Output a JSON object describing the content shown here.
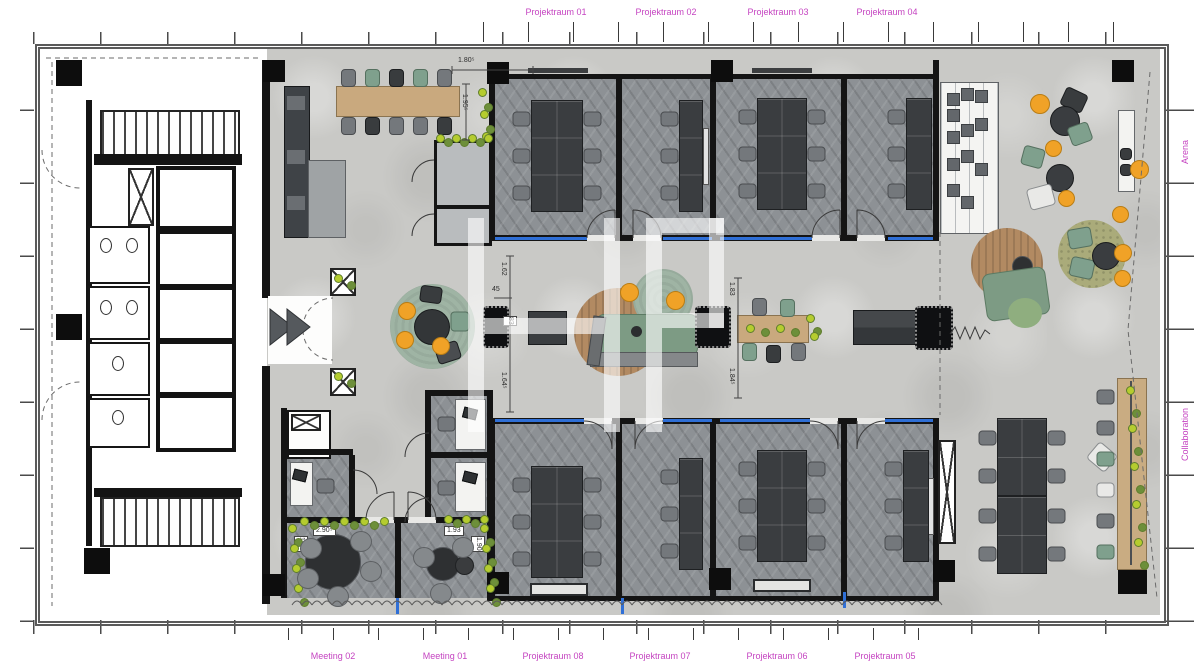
{
  "labels": {
    "top": [
      "Projektraum 01",
      "Projektraum 02",
      "Projektraum 03",
      "Projektraum 04"
    ],
    "bottom": [
      "Meeting 02",
      "Meeting 01",
      "Projektraum 08",
      "Projektraum 07",
      "Projektraum 06",
      "Projektraum 05"
    ],
    "right": [
      "Arena",
      "Collaboration"
    ]
  },
  "watermark": "HP",
  "dims": {
    "top_table_w": "1.80⁵",
    "top_table_h": "1.95⁵",
    "mid_left_a": "1.62",
    "mid_left_b": "45",
    "mid_left_c": "83",
    "mid_left_d": "1.64⁵",
    "mid_right_a": "1.83",
    "mid_right_b": "1.84⁵",
    "meeting02_w": "2.90⁵",
    "meeting02_h": "1.90",
    "meeting01_w": "1.93",
    "meeting01_h": "1.90"
  },
  "colors": {
    "label_magenta": "#c544c1",
    "glass_blue": "#2f6fd6",
    "floor_concrete": "#c9c9c6",
    "carpet_gray": "#8d9195",
    "wall_black": "#141414",
    "wood_tan": "#c9a97e",
    "table_dark": "#3a3d40",
    "chair_gray": "#74787c",
    "chair_green": "#7fa08d",
    "pouf_orange": "#f0a227",
    "rug_green": "#9fb4a4",
    "rug_olive": "#aaab7a",
    "rug_brown": "#b28a62",
    "plant_green": "#b5cc2f",
    "sofa_green": "#7d9b84"
  }
}
